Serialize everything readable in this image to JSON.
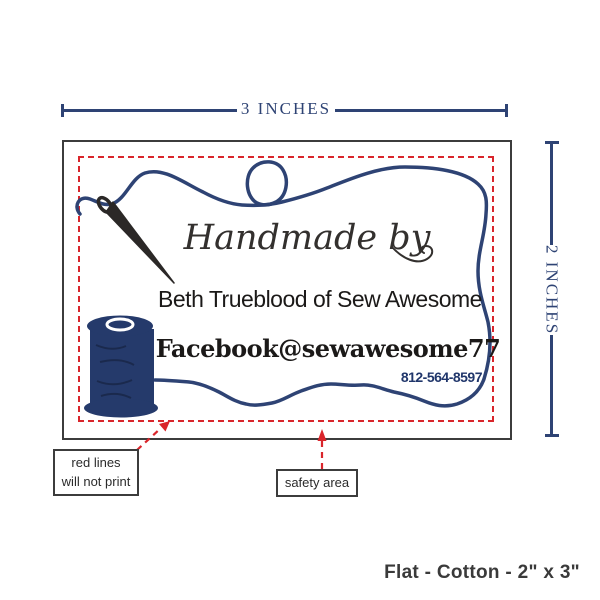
{
  "dimension_annotations": {
    "width": "3 INCHES",
    "height": "2 INCHES"
  },
  "label_preview": {
    "script_line": "Handmade by",
    "name_line": "Beth Trueblood of Sew Awesome",
    "social_line": "Facebook@sewawesome77",
    "phone_line": "812-564-8597"
  },
  "callouts": {
    "red_lines_line1": "red lines",
    "red_lines_line2": "will not print",
    "safety_area": "safety area"
  },
  "footer": {
    "spec": "Flat - Cotton - 2\" x 3\""
  },
  "icons": {
    "needle": "needle-and-thread-icon",
    "spool": "thread-spool-icon"
  },
  "colors": {
    "navy": "#2e4374",
    "spool_navy": "#253a6b",
    "phone_navy": "#20366b",
    "red": "#d9252b",
    "frame": "#3c3c3c",
    "ink": "#1b1918",
    "script_ink": "#33302e",
    "footer_gray": "#3a3a3a"
  }
}
